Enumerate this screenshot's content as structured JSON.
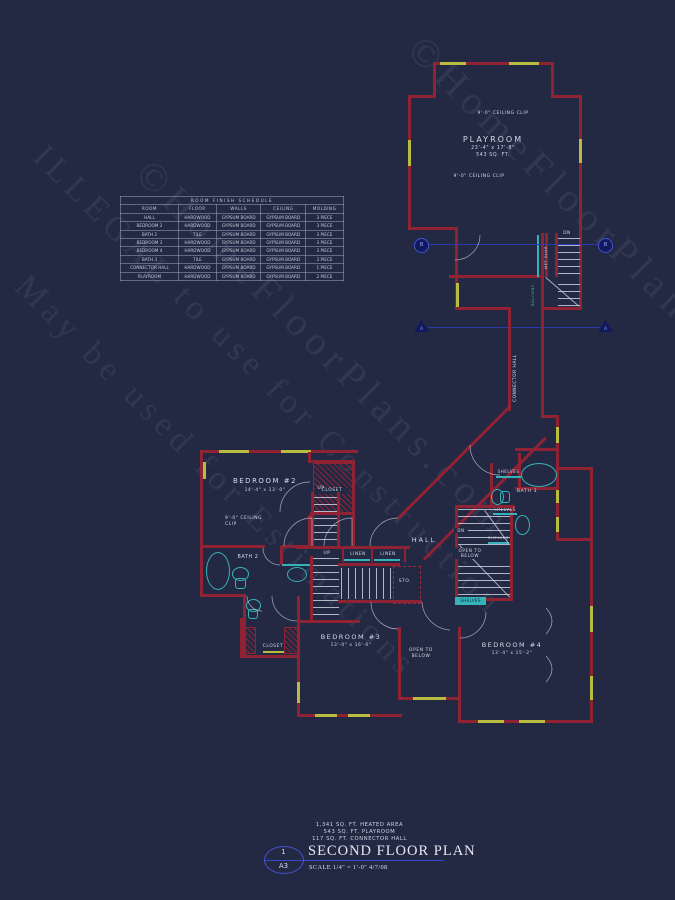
{
  "colors": {
    "background": "#242943",
    "wall_red": "#8f2233",
    "window_yellow": "#b9bc3f",
    "fixture_cyan": "#35b3b8",
    "text_light": "#d4d9e8",
    "section_blue": "#3646c8"
  },
  "watermarks": {
    "brand": "©HomeFloorPlans.com",
    "illegal": "ILLEGAL to use for Construction",
    "may_be": "May be used for Estimations"
  },
  "schedule": {
    "title": "ROOM FINISH SCHEDULE",
    "headers": [
      "ROOM",
      "FLOOR",
      "WALLS",
      "CEILING",
      "MOLDING"
    ],
    "rows": [
      {
        "room": "HALL",
        "floor": "HARDWOOD",
        "walls": "GYPSUM BOARD",
        "ceiling": "GYPSUM BOARD",
        "molding": "3 PIECE"
      },
      {
        "room": "BEDROOM 2",
        "floor": "HARDWOOD",
        "walls": "GYPSUM BOARD",
        "ceiling": "GYPSUM BOARD",
        "molding": "3 PIECE"
      },
      {
        "room": "BATH 2",
        "floor": "TILE",
        "walls": "GYPSUM BOARD",
        "ceiling": "GYPSUM BOARD",
        "molding": "3 PIECE"
      },
      {
        "room": "BEDROOM 3",
        "floor": "HARDWOOD",
        "walls": "GYPSUM BOARD",
        "ceiling": "GYPSUM BOARD",
        "molding": "3 PIECE"
      },
      {
        "room": "BEDROOM 4",
        "floor": "HARDWOOD",
        "walls": "GYPSUM BOARD",
        "ceiling": "GYPSUM BOARD",
        "molding": "3 PIECE"
      },
      {
        "room": "BATH 3",
        "floor": "TILE",
        "walls": "GYPSUM BOARD",
        "ceiling": "GYPSUM BOARD",
        "molding": "3 PIECE"
      },
      {
        "room": "CONNECTOR HALL",
        "floor": "HARDWOOD",
        "walls": "GYPSUM BOARD",
        "ceiling": "GYPSUM BOARD",
        "molding": "1 PIECE"
      },
      {
        "room": "PLAYROOM",
        "floor": "HARDWOOD",
        "walls": "GYPSUM BOARD",
        "ceiling": "GYPSUM BOARD",
        "molding": "2 PIECE"
      }
    ]
  },
  "rooms": {
    "playroom": {
      "name": "PLAYROOM",
      "dims": "23'-4\" x 17'-8\"",
      "area": "543 SQ. FT."
    },
    "bedroom2": {
      "name": "BEDROOM #2",
      "dims": "14'-4\" x 13'-0\""
    },
    "bedroom3": {
      "name": "BEDROOM #3",
      "dims": "13'-0\" x 16'-0\""
    },
    "bedroom4": {
      "name": "BEDROOM #4",
      "dims": "13'-4\" x 15'-2\""
    },
    "bath2": "BATH 2",
    "bath3": "BATH 3",
    "hall": "HALL"
  },
  "labels": {
    "ceiling_clip": "9'-0\" CEILING CLIP",
    "ceiling_clip_2line": "9'-0\" CEILING\nCLIP",
    "closet": "CLOSET",
    "linen": "LINEN",
    "shelves": "SHELVES",
    "open_to_below": "OPEN TO\nBELOW",
    "up": "UP",
    "dn": "DN",
    "sto": "STO.",
    "balcony": "BALCONY",
    "met_guar": "MET GUAR",
    "connector_hall": "CONNECTOR HALL"
  },
  "section_markers": {
    "a": "A",
    "b": "B"
  },
  "title_block": {
    "stats": "1,341 SQ. FT. HEATED AREA\n543 SQ. FT. PLAYROOM\n117 SQ. FT. CONNECTOR HALL",
    "sheet_number": "1",
    "sheet_ref": "A3",
    "title": "SECOND FLOOR PLAN",
    "scale": "SCALE 1/4\" = 1'-0\"    4/7/08"
  }
}
